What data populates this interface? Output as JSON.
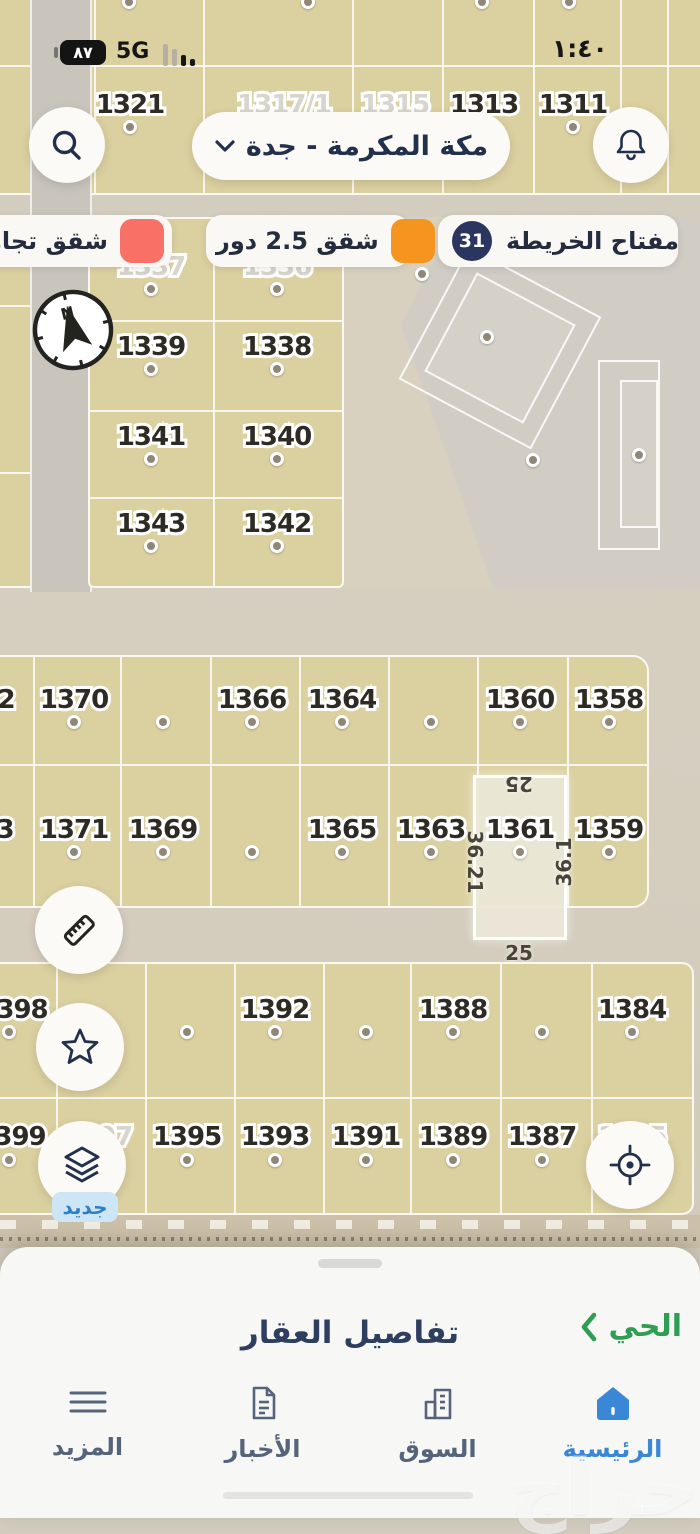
{
  "status_bar": {
    "battery": "٨٧",
    "network": "5G",
    "time": "١:٤٠"
  },
  "header": {
    "location_label": "مكة المكرمة - جدة"
  },
  "legend": {
    "map_key_label": "مفتاح الخريطة",
    "map_key_count": "31",
    "items": [
      {
        "label": "شقق 2.5 دور",
        "color": "#F5941F"
      },
      {
        "label": "شقق تجاري",
        "color": "#F87066"
      }
    ]
  },
  "map": {
    "compass_label": "N",
    "new_badge_label": "جديد",
    "selected": {
      "id": "1361",
      "top": "25",
      "bottom": "25",
      "left": "36.21",
      "right": "36.1"
    },
    "parcels": [
      {
        "id": "1321",
        "x": 130,
        "y": 105
      },
      {
        "id": "1317/1",
        "x": 284,
        "y": 105,
        "light": true
      },
      {
        "id": "1315",
        "x": 395,
        "y": 105,
        "light": true
      },
      {
        "id": "1313",
        "x": 484,
        "y": 105
      },
      {
        "id": "1311",
        "x": 573,
        "y": 105
      },
      {
        "id": "1337",
        "x": 151,
        "y": 267,
        "light": true
      },
      {
        "id": "1336",
        "x": 277,
        "y": 267,
        "light": true
      },
      {
        "id": "1339",
        "x": 151,
        "y": 347
      },
      {
        "id": "1338",
        "x": 277,
        "y": 347
      },
      {
        "id": "1341",
        "x": 151,
        "y": 437
      },
      {
        "id": "1340",
        "x": 277,
        "y": 437
      },
      {
        "id": "1343",
        "x": 151,
        "y": 524
      },
      {
        "id": "1342",
        "x": 277,
        "y": 524
      },
      {
        "id": "2",
        "x": 6,
        "y": 700
      },
      {
        "id": "1370",
        "x": 74,
        "y": 700
      },
      {
        "id": "1366",
        "x": 252,
        "y": 700
      },
      {
        "id": "1364",
        "x": 342,
        "y": 700
      },
      {
        "id": "1360",
        "x": 520,
        "y": 700
      },
      {
        "id": "1358",
        "x": 609,
        "y": 700
      },
      {
        "id": "3",
        "x": 5,
        "y": 830
      },
      {
        "id": "1371",
        "x": 74,
        "y": 830
      },
      {
        "id": "1369",
        "x": 163,
        "y": 830
      },
      {
        "id": "1365",
        "x": 342,
        "y": 830
      },
      {
        "id": "1363",
        "x": 431,
        "y": 830
      },
      {
        "id": "1361",
        "x": 520,
        "y": 830
      },
      {
        "id": "1359",
        "x": 609,
        "y": 830
      },
      {
        "id": "398",
        "x": 22,
        "y": 1010
      },
      {
        "id": "1392",
        "x": 275,
        "y": 1010
      },
      {
        "id": "1388",
        "x": 453,
        "y": 1010
      },
      {
        "id": "1384",
        "x": 632,
        "y": 1010
      },
      {
        "id": "399",
        "x": 20,
        "y": 1137
      },
      {
        "id": "1397",
        "x": 98,
        "y": 1137,
        "light": true
      },
      {
        "id": "1395",
        "x": 187,
        "y": 1137
      },
      {
        "id": "1393",
        "x": 275,
        "y": 1137
      },
      {
        "id": "1391",
        "x": 366,
        "y": 1137
      },
      {
        "id": "1389",
        "x": 453,
        "y": 1137
      },
      {
        "id": "1387",
        "x": 542,
        "y": 1137
      },
      {
        "id": "1385",
        "x": 632,
        "y": 1137,
        "light": true
      }
    ],
    "dots": [
      [
        129,
        2
      ],
      [
        308,
        2
      ],
      [
        482,
        2
      ],
      [
        569,
        2
      ],
      [
        130,
        127
      ],
      [
        284,
        127
      ],
      [
        395,
        127
      ],
      [
        484,
        127
      ],
      [
        573,
        127
      ],
      [
        151,
        289
      ],
      [
        277,
        289
      ],
      [
        151,
        369
      ],
      [
        277,
        369
      ],
      [
        151,
        459
      ],
      [
        277,
        459
      ],
      [
        151,
        546
      ],
      [
        277,
        546
      ],
      [
        422,
        274
      ],
      [
        487,
        337
      ],
      [
        533,
        460
      ],
      [
        639,
        455
      ],
      [
        74,
        722
      ],
      [
        163,
        722
      ],
      [
        252,
        722
      ],
      [
        342,
        722
      ],
      [
        431,
        722
      ],
      [
        520,
        722
      ],
      [
        609,
        722
      ],
      [
        74,
        852
      ],
      [
        163,
        852
      ],
      [
        252,
        852
      ],
      [
        342,
        852
      ],
      [
        431,
        852
      ],
      [
        520,
        852
      ],
      [
        609,
        852
      ],
      [
        9,
        1032
      ],
      [
        187,
        1032
      ],
      [
        275,
        1032
      ],
      [
        366,
        1032
      ],
      [
        453,
        1032
      ],
      [
        542,
        1032
      ],
      [
        632,
        1032
      ],
      [
        9,
        1160
      ],
      [
        187,
        1160
      ],
      [
        275,
        1160
      ],
      [
        366,
        1160
      ],
      [
        453,
        1160
      ],
      [
        542,
        1160
      ]
    ]
  },
  "bottom_sheet": {
    "district_label": "الحي",
    "details_label": "تفاصيل العقار"
  },
  "nav": {
    "items": [
      {
        "label": "المزيد"
      },
      {
        "label": "الأخبار"
      },
      {
        "label": "السوق"
      },
      {
        "label": "الرئيسية",
        "active": true
      }
    ]
  },
  "watermark": "حراج",
  "icons": {
    "search": "magnifier",
    "notifications": "bell",
    "location_chevron": "chevron-down",
    "compass": "north-arrow",
    "measure": "ruler",
    "favorite": "star",
    "layers": "stacked-layers",
    "locate": "crosshair-target",
    "district_chevron": "chevron-left",
    "nav_home": "house",
    "nav_market": "buildings",
    "nav_news": "newspaper",
    "nav_more": "hamburger-lines"
  }
}
